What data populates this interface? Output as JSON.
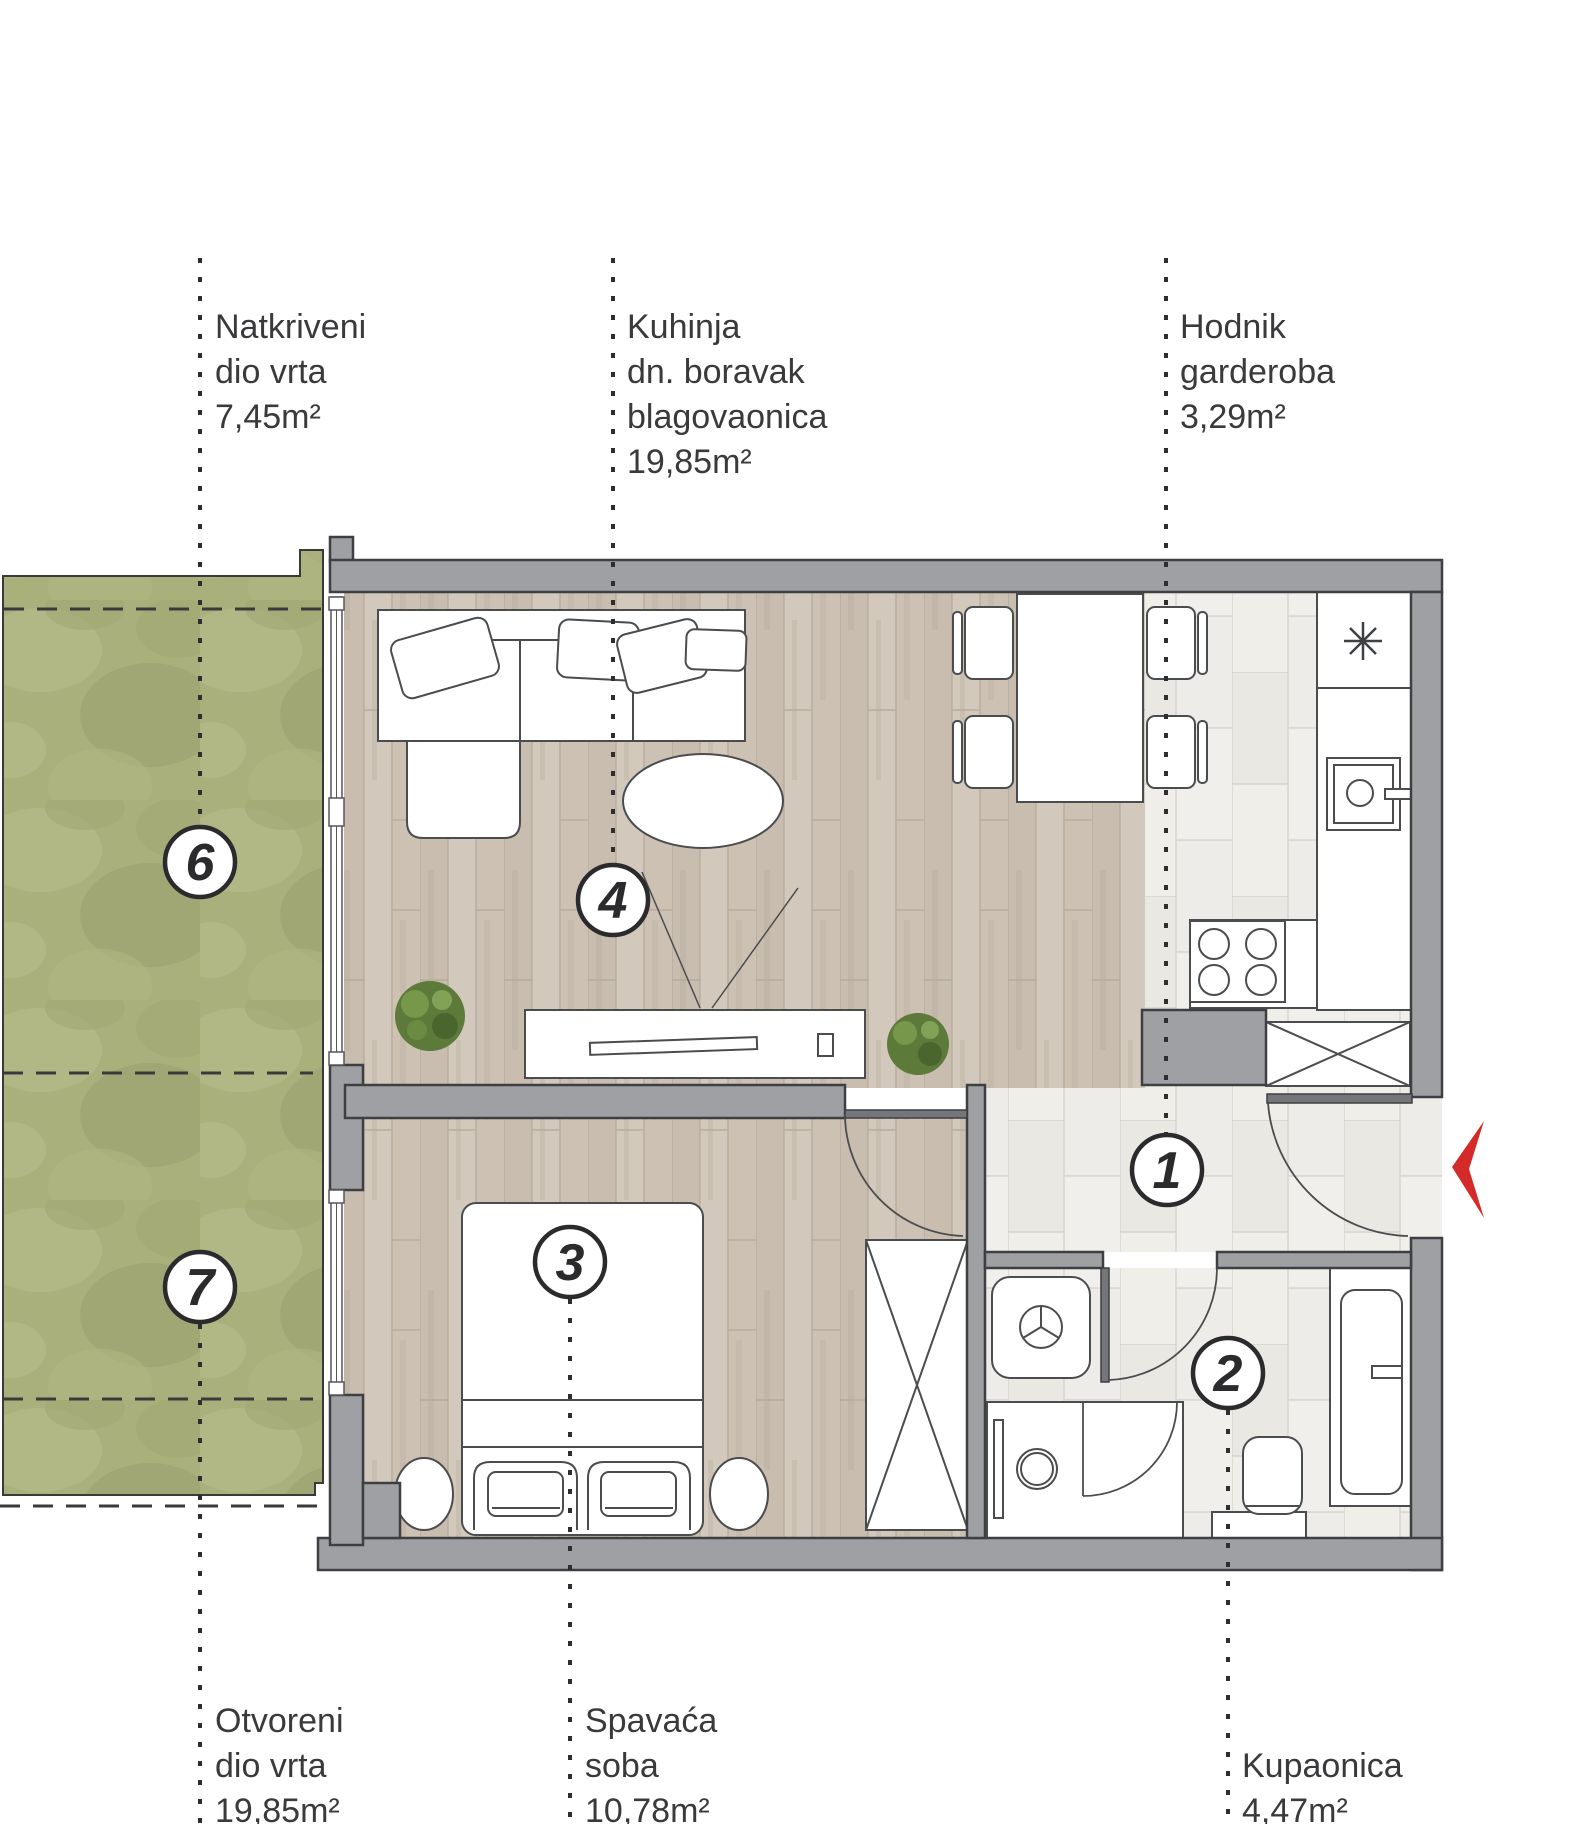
{
  "title": "Apartment floor plan",
  "rooms": [
    {
      "number": "1",
      "name": "Hodnik garderoba",
      "area": "3,29m²"
    },
    {
      "number": "2",
      "name": "Kupaonica",
      "area": "4,47m²"
    },
    {
      "number": "3",
      "name": "Spavaća soba",
      "area": "10,78m²"
    },
    {
      "number": "4",
      "name": "Kuhinja dn. boravak blagovaonica",
      "area": "19,85m²"
    },
    {
      "number": "6",
      "name": "Natkriveni dio vrta",
      "area": "7,45m²"
    },
    {
      "number": "7",
      "name": "Otvoreni dio vrta",
      "area": "19,85m²"
    }
  ],
  "labels": [
    {
      "id": "natkriveni-dio-vrta",
      "lines": [
        "Natkriveni",
        "dio vrta",
        "7,45m²"
      ]
    },
    {
      "id": "kuhinja-dnevni-boravak",
      "lines": [
        "Kuhinja",
        "dn. boravak",
        "blagovaonica",
        "19,85m²"
      ]
    },
    {
      "id": "hodnik-garderoba",
      "lines": [
        "Hodnik",
        "garderoba",
        "3,29m²"
      ]
    },
    {
      "id": "otvoreni-dio-vrta",
      "lines": [
        "Otvoreni",
        "dio vrta",
        "19,85m²"
      ]
    },
    {
      "id": "spavaca-soba",
      "lines": [
        "Spavaća",
        "soba",
        "10,78m²"
      ]
    },
    {
      "id": "kupaonica",
      "lines": [
        "Kupaonica",
        "4,47m²"
      ]
    }
  ],
  "symbols": {
    "entrance_arrow": "red-chevron-left",
    "fridge": "snowflake",
    "shower": "drain-circle",
    "wardrobes": "crossed-box"
  },
  "colors": {
    "wall": "#9EA0A3",
    "wall_outline": "#3E3F42",
    "door_leaf": "#74767A",
    "wood_floor": "#CDC3B6",
    "tile_floor": "#EDECE8",
    "grass": "#A9B07C",
    "entrance_arrow_red": "#D42A28",
    "line": "#4B4C4E",
    "text": "#3A3A3C"
  }
}
